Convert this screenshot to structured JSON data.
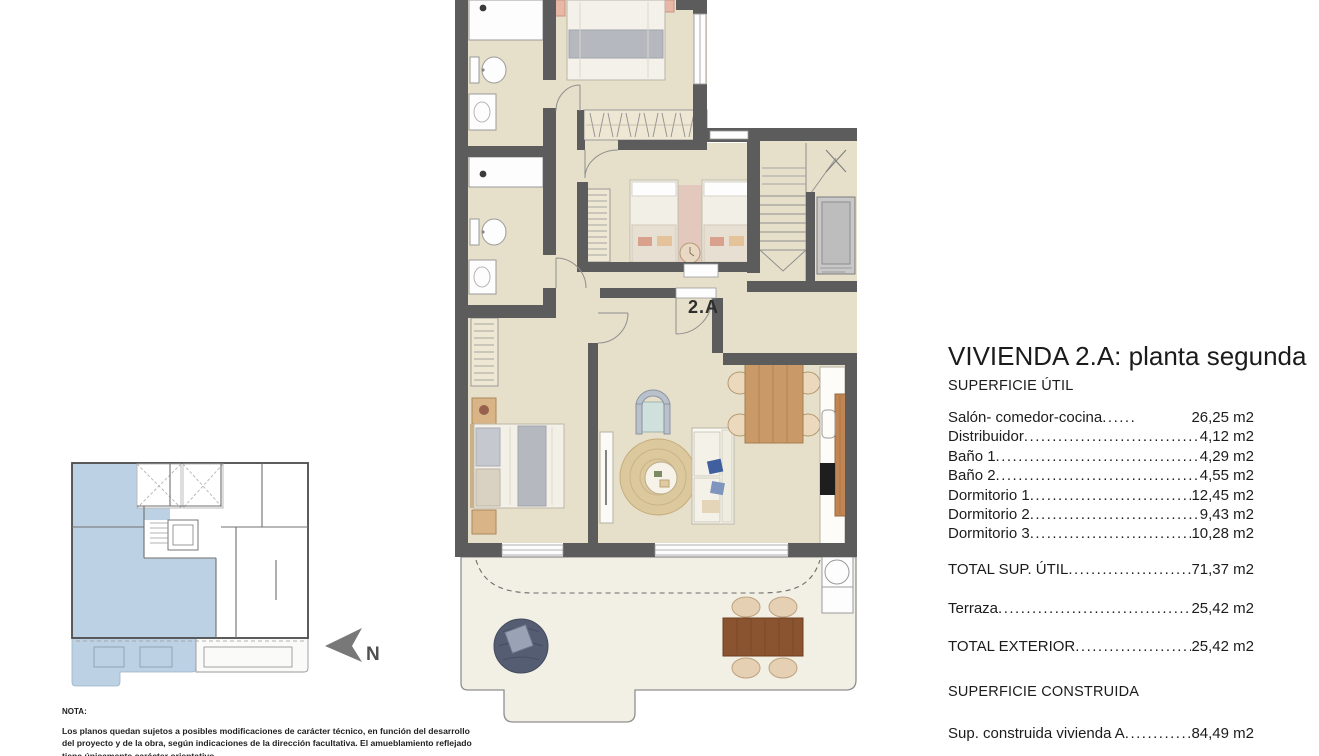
{
  "plan": {
    "unit_label": "2.A"
  },
  "key_plan": {
    "north_label": "N"
  },
  "panel": {
    "title": "VIVIENDA 2.A: planta segunda",
    "section_util": "SUPERFICIE ÚTIL",
    "rows": [
      {
        "label": "Salón- comedor-cocina",
        "value": "26,25 m2"
      },
      {
        "label": "Distribuidor",
        "value": "4,12 m2"
      },
      {
        "label": "Baño 1",
        "value": "4,29 m2"
      },
      {
        "label": "Baño 2",
        "value": "4,55 m2"
      },
      {
        "label": "Dormitorio 1",
        "value": "12,45 m2"
      },
      {
        "label": "Dormitorio 2",
        "value": "9,43 m2"
      },
      {
        "label": "Dormitorio 3",
        "value": "10,28 m2"
      }
    ],
    "total_util": {
      "label": "TOTAL SUP. ÚTIL",
      "value": "71,37 m2"
    },
    "terraza": {
      "label": "Terraza",
      "value": "25,42 m2"
    },
    "total_exterior": {
      "label": "TOTAL EXTERIOR",
      "value": "25,42 m2"
    },
    "section_construida": "SUPERFICIE CONSTRUIDA",
    "construida": {
      "label": "Sup. construida vivienda A",
      "value": "84,49 m2"
    }
  },
  "note": {
    "heading": "NOTA:",
    "line1": "Los planos quedan sujetos a posibles modificaciones de carácter técnico, en función del desarrollo",
    "line2": "del proyecto y de la obra, según indicaciones de la dirección facultativa. El amueblamiento reflejado",
    "line3": "tiene únicamente carácter orientativo."
  },
  "colors": {
    "floor": "#e6dfca",
    "wall": "#5c5c5c",
    "terrace": "#f2efe4",
    "unit_highlight": "#bcd2e4",
    "wood": "#c99a67",
    "dark_wood": "#8a5430"
  }
}
